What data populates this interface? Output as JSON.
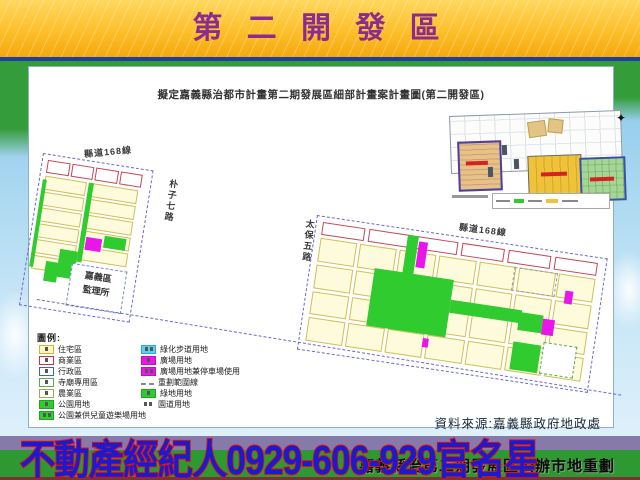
{
  "header": {
    "title": "第 二 開 發 區"
  },
  "map": {
    "title": "擬定嘉義縣治都市計畫第二期發展區細部計畫案計畫圖(第二開發區)",
    "source": "資料來源:嘉義縣政府地政處",
    "labels": {
      "county_road_left": "縣道168線",
      "county_road_right": "縣道168線",
      "puzi_road": "朴子七路",
      "taibao_road": "太保五路",
      "dmv_line1": "嘉義區",
      "dmv_line2": "監理所"
    },
    "north_icon": "✦"
  },
  "legend": {
    "title": "圖例:",
    "left": [
      {
        "label": "住宅區"
      },
      {
        "label": "商業區"
      },
      {
        "label": "行政區"
      },
      {
        "label": "寺廟專用區"
      },
      {
        "label": "農業區"
      },
      {
        "label": "公園用地"
      },
      {
        "label": "公園兼供兒童遊樂場用地"
      }
    ],
    "right": [
      {
        "label": "綠化步道用地"
      },
      {
        "label": "廣場用地"
      },
      {
        "label": "廣場用地兼停車場使用"
      },
      {
        "label": "重劃範圍線"
      },
      {
        "label": "綠地用地"
      },
      {
        "label": "園道用地"
      }
    ]
  },
  "footer": {
    "banner": "嘉義縣治第二期發展區公辦市地重劃",
    "ad": "不動產經紀人0929-606-929官名星"
  },
  "colors": {
    "header_yellow": "#FDBF2B",
    "title_purple": "#8B2B8F",
    "divider_blue": "#1D3FA0",
    "footer_green": "#2E9933",
    "footer_stripe_purple": "#867AAB",
    "ad_blue": "#1A1ACE",
    "ad_outline_red": "#E01010",
    "map_park_green": "#2FCB2F",
    "map_plaza_magenta": "#E816E8",
    "map_residential_yellow": "#FEFBDC",
    "map_boundary_dash": "#6A6ACB"
  }
}
